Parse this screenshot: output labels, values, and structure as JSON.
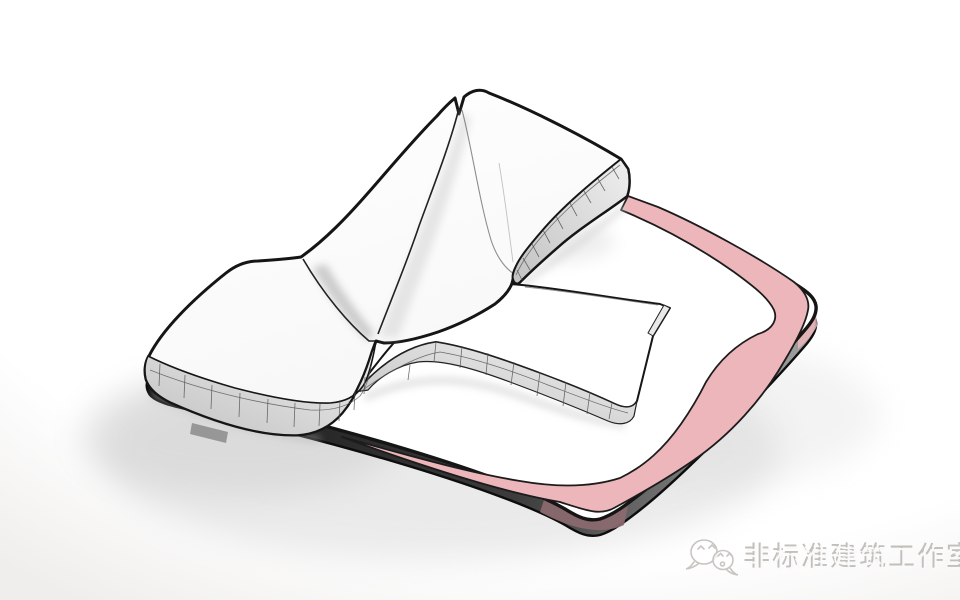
{
  "scene": {
    "type": "3d-architectural-massing-render",
    "view": "axonometric-birdseye",
    "parts": {
      "site_plate": "site-plate",
      "building_shell": "curved-roof-building-shell",
      "left_wing": "left-wing-block",
      "ne_wing": "north-east-wing-block",
      "podium": "podium-slab-building",
      "pink_path": "pedestrian-path-ribbon",
      "ground": "site-ground"
    }
  },
  "colors": {
    "background_top": "#ffffff",
    "background_edge": "#efeeec",
    "outline": "#151515",
    "surface_white": "#ffffff",
    "path_pink": "#ecb6ba",
    "path_pink_side": "#8d6a6f",
    "facade_light": "#efefef",
    "facade_dark": "#c2c2c2",
    "plate_side_dark": "#161616",
    "plate_side_light": "#a2a2a2",
    "shadow_soft": "#cccccc",
    "watermark_line": "#c9c5c1",
    "watermark_text_dark": "#c3bfbb",
    "watermark_text_light": "#fbfafa"
  },
  "watermark": {
    "icon": "wechat-logo-icon",
    "text": "非标准建筑工作室"
  }
}
